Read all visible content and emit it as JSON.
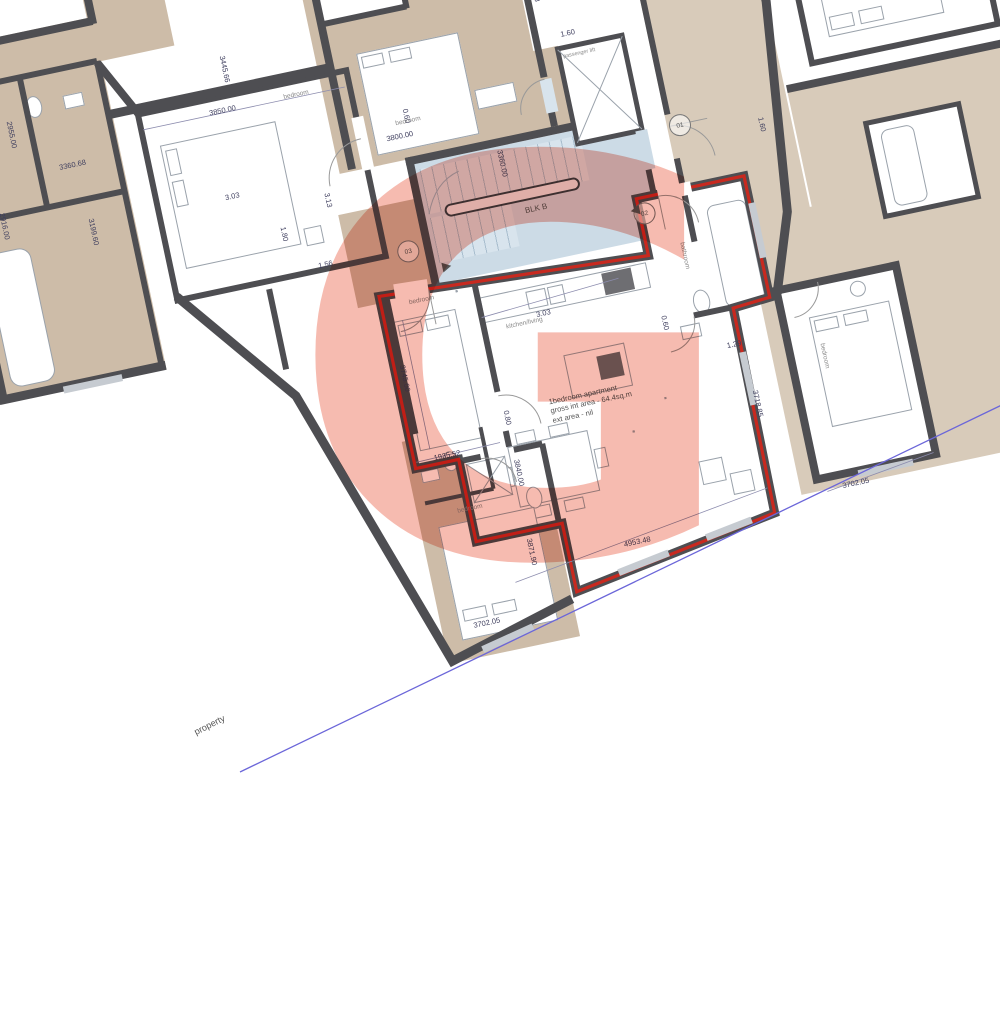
{
  "watermark": "G",
  "site": {
    "property_line_label": "property"
  },
  "block": {
    "label": "BLK B",
    "lift_label": "passenger lift",
    "doors": {
      "d01": "01",
      "d02": "02",
      "d03": "03"
    }
  },
  "apartment": {
    "note": [
      "1bedroom apartment",
      "gross int area - 64.4sq.m",
      "ext area - nil"
    ],
    "rooms": {
      "bedroom": "bedroom",
      "bathroom": "bathroom",
      "kitchen_living": "kitchen/living"
    }
  },
  "neighbors": {
    "bedroom_left": "bedroom",
    "bedroom_top": "bedroom",
    "bedroom_bottom": "bedroom",
    "bedroom_right": "bedroom"
  },
  "dims": {
    "blk_top": "3800.00",
    "top_bedroom_height": "3360.00",
    "top_shower": "0.60",
    "lift_lobby_a": "1.53",
    "lift_lobby_b": "1.60",
    "hall_right": "1.60",
    "left_bedroom_top": "3850.00",
    "left_wing_a": "3445.66",
    "vest_a": "3.03",
    "vest_b": "3.13",
    "vest_c": "1.80",
    "vest_d": "1.56",
    "far_left_a": "3360.68",
    "far_left_b": "3199.60",
    "far_left_c": "2955.00",
    "far_left_d": "2916.00",
    "kitchen_width": "3.03",
    "apt_bedroom_depth": "3745.00",
    "apt_bedroom_width": "1935.52",
    "apt_wc": "0.80",
    "bathroom_a": "0.60",
    "bathroom_b": "1.29",
    "living_left": "3840.00",
    "living_width": "4953.48",
    "bottom_bedroom_width": "3702.05",
    "bottom_bedroom_depth": "3871.90",
    "right_bedroom_width": "3702.05",
    "right_bedroom_depth": "3718.85"
  },
  "colors": {
    "wall": "#4e4e52",
    "boundary_red": "#c8291f",
    "corridor_blue": "#ccdbe6",
    "tan_dark": "#cdbca8",
    "tan_light": "#d8cbba",
    "watermark": "#ea6950",
    "property_line": "#6b66d9"
  }
}
